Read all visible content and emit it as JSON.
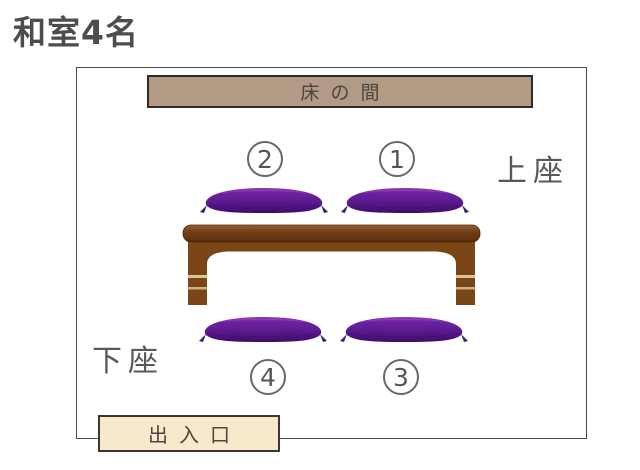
{
  "title": "和室4名",
  "room": {
    "tokonoma_label": "床の間",
    "kamiza_label": "上座",
    "shimoza_label": "下座",
    "exit_label": "出入口",
    "seats": [
      {
        "number": "1",
        "position": "top-right"
      },
      {
        "number": "2",
        "position": "top-left"
      },
      {
        "number": "3",
        "position": "bottom-right"
      },
      {
        "number": "4",
        "position": "bottom-left"
      }
    ]
  },
  "colors": {
    "tokonoma_fill": "#b29a84",
    "exit_fill": "#f8e8cc",
    "cushion_purple": "#5c1b90",
    "tassel_navy": "#232a78",
    "table_brown": "#7b4616",
    "text_gray": "#595959",
    "border_dark": "#3b3831",
    "title_gray": "#4d4d4d"
  }
}
